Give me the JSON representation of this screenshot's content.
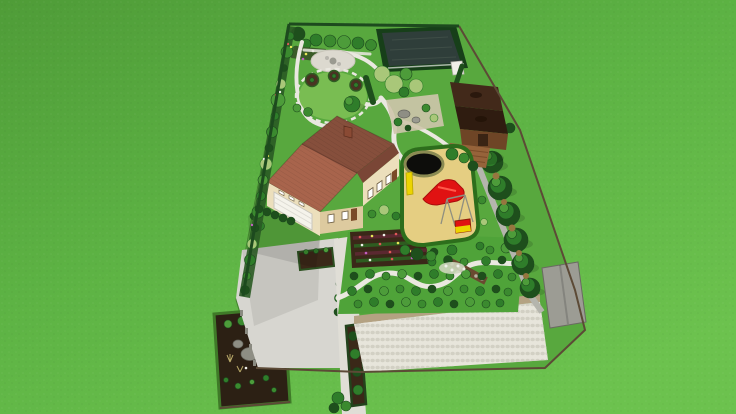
{
  "scene": {
    "description": "Aerial 3D rendering of a landscape design for a long rectangular residential plot on a mowed green lawn, viewed in tilted perspective",
    "elements": [
      {
        "name": "surrounding-lawn",
        "description": "Bright mowed lawn covering the whole scene around the plot"
      },
      {
        "name": "property-plot",
        "description": "Long rectangular residential plot shown in tilted aerial perspective"
      },
      {
        "name": "perimeter-planting",
        "description": "Mixed shrub and flower border along the left boundary"
      },
      {
        "name": "orchard-row",
        "description": "Row of small fruit trees along the back boundary"
      },
      {
        "name": "swimming-pond",
        "description": "Dark rectangular swimming pond framed by a clipped hedge in the back right corner"
      },
      {
        "name": "gravel-patio",
        "description": "Light gravel seating patio with a small table in the back garden"
      },
      {
        "name": "circular-lawn",
        "description": "Round lawn ringed by a stepping-stone path with three round planting beds and a specimen tree"
      },
      {
        "name": "garden-paths",
        "description": "Winding white stone paths connecting the garden areas"
      },
      {
        "name": "willow-group",
        "description": "Light-green weeping trees between the pond and the rock garden"
      },
      {
        "name": "rock-garden",
        "description": "Gravel rockery with boulders and plantings behind the house"
      },
      {
        "name": "gazebo",
        "description": "Dark-roofed wooden gazebo with a front deck on the right boundary"
      },
      {
        "name": "house",
        "description": "Two-storey house with brown hipped roof, cream walls, windows and attached garage"
      },
      {
        "name": "garage-door",
        "description": "White sectional garage door facing the courtyard"
      },
      {
        "name": "playground",
        "description": "Hedge-enclosed play area with an ochre sand surface"
      },
      {
        "name": "play-pool",
        "description": "Round black splash pool at the corner of the play area"
      },
      {
        "name": "slide",
        "description": "Bright red slide structure on the sand"
      },
      {
        "name": "swing-frame",
        "description": "Thin metal swing frame beside the slide"
      },
      {
        "name": "playhouse",
        "description": "Small red and yellow play box"
      },
      {
        "name": "conifer-row",
        "description": "Row of tall conifers screening the right boundary"
      },
      {
        "name": "side-path",
        "description": "Grey service path running along the conifer row"
      },
      {
        "name": "flower-garden",
        "description": "Dark flower bed with rows of red, yellow, white and purple blooms in front of the house"
      },
      {
        "name": "shrub-garden",
        "description": "Large garden of low shrubs planted in rows, crossed by a winding white path"
      },
      {
        "name": "dry-creek",
        "description": "Brown dry-creek band with stones inside the shrub garden"
      },
      {
        "name": "courtyard",
        "description": "Large concrete courtyard and driveway in front of the garage"
      },
      {
        "name": "soil-bed",
        "description": "Square dark-soil planting bed on the courtyard"
      },
      {
        "name": "conifer-hedge-line",
        "description": "Line of small clipped conifers separating courtyard and walkway"
      },
      {
        "name": "entrance-walkway",
        "description": "Light walkway leading from the street frontage to the front door"
      },
      {
        "name": "walkway-planter",
        "description": "Narrow planter of small conifers set into the walkway"
      },
      {
        "name": "rock-bed",
        "description": "Bottom-left display bed with boulders, dark soil and young plants"
      },
      {
        "name": "paver-plaza",
        "description": "Large cobble-paved plaza across the street frontage"
      },
      {
        "name": "retaining-wall",
        "description": "Low tan wall edging the plaza"
      },
      {
        "name": "shed-pad",
        "description": "Grey utility pad in the bottom-right corner"
      },
      {
        "name": "boundary-fence",
        "description": "Thin brown fence line around the plot"
      }
    ]
  },
  "palette": {
    "grass_a": "#4f9c38",
    "grass_b": "#5db344",
    "grass_c": "#6cc24e",
    "plot_lawn": "#58a83e",
    "lawn_circle": "#79bd52",
    "garden_lawn": "#4fa339",
    "border_hedge": "#1d4a1e",
    "hedge_base": "#2a5a24",
    "fence": "#5c4a36",
    "pond_water": "#2f3e3a",
    "pond_hedge": "#173f19",
    "pond_ripple": "#49584f",
    "path_white": "#eae8e0",
    "path_gray": "#b5b5ad",
    "concrete": "#d7d6d0",
    "walkway": "#e0ded6",
    "apron": "#e6e4dc",
    "paver": "#e7e5db",
    "paver_dot": "#d2d0c4",
    "wall_tan": "#b4a282",
    "roof_light": "#a8644c",
    "roof_dark": "#864f3c",
    "roof_edge": "#6e3f30",
    "porch_roof": "#7a4636",
    "chimney": "#8a4a34",
    "wall_cream": "#ecdfbc",
    "wall_shade": "#ddca9f",
    "garage_door": "#f5f3eb",
    "door_brown": "#7a4a28",
    "window_white": "#ffffff",
    "window_frame": "#6b5b3f",
    "step_gray": "#b8b6ae",
    "gazebo_roof": "#42291a",
    "gazebo_roof_dark": "#2f1c10",
    "gazebo_wall": "#6e4526",
    "gazebo_door": "#3a2414",
    "gazebo_deck": "#96633a",
    "deck_line": "#7a4c28",
    "sand": "#e5ce82",
    "play_border": "#2d6e1c",
    "slide_red": "#e01212",
    "slide_dark": "#a80c0c",
    "toy_yellow": "#ecd400",
    "pool_black": "#0d0d0b",
    "pool_rim": "#8a8a52",
    "tree_dark": "#1e4f1c",
    "tree_mid": "#2f7d2a",
    "tree_light": "#4d9c3a",
    "shrub_green": "#3b8a2f",
    "willow": "#a9c779",
    "pale_leaf": "#cdd6bd",
    "grass_tan": "#b8a868",
    "tan_shrub": "#96763f",
    "rock_gray": "#8e8e84",
    "rock_light": "#9a9a90",
    "shed_gray": "#9c9c94",
    "soil_bed": "#3a2818",
    "soil_dark": "#2c2014",
    "bed_brown": "#4a3322",
    "pebble": "#cfc5ac",
    "creek": "#6a4a30",
    "stone_dot": "#b8b0a0",
    "row_red": "#5a2830",
    "row_green": "#2e5c20",
    "flower_red": "#e05858",
    "flower_yellow": "#e8e858",
    "flower_white": "#f0f0ea",
    "flower_purple": "#c060c0",
    "patio_gravel": "#dcd9cf",
    "table_gray": "#9a9a90",
    "gate_white": "#f0efe8",
    "post_gray": "#8a8a80"
  }
}
